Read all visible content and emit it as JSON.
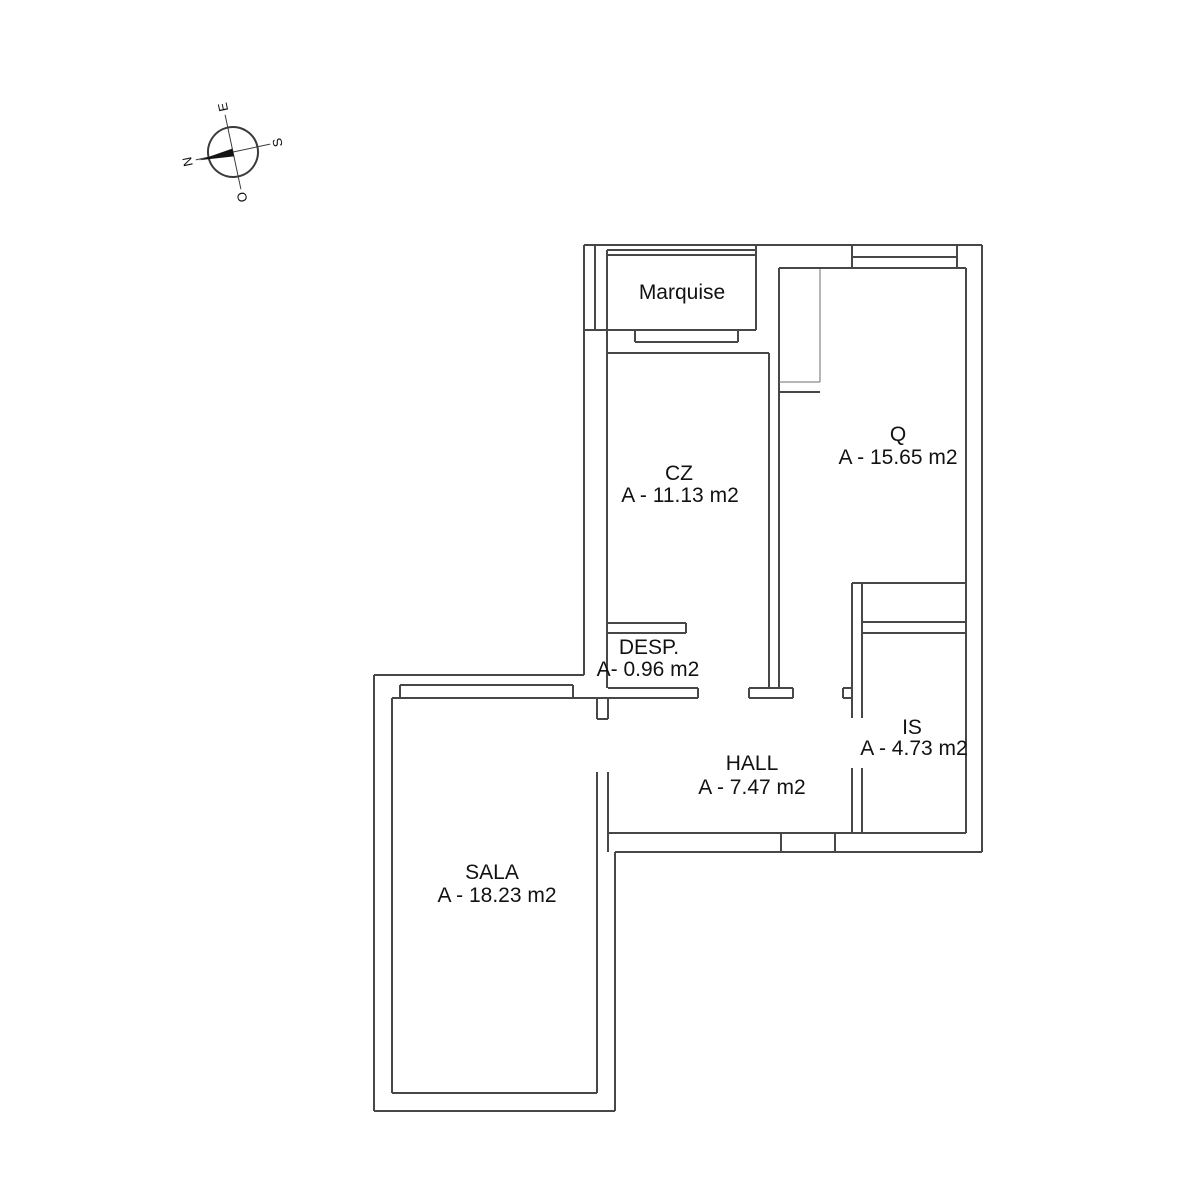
{
  "compass": {
    "n": "N",
    "e": "E",
    "s": "S",
    "o": "O"
  },
  "rooms": [
    {
      "name": "Marquise"
    },
    {
      "name": "CZ",
      "area": "A - 11.13 m2"
    },
    {
      "name": "Q",
      "area": "A - 15.65 m2"
    },
    {
      "name": "DESP.",
      "area": "A- 0.96 m2"
    },
    {
      "name": "HALL",
      "area": "A - 7.47 m2"
    },
    {
      "name": "IS",
      "area": "A - 4.73 m2"
    },
    {
      "name": "SALA",
      "area": "A - 18.23 m2"
    }
  ]
}
